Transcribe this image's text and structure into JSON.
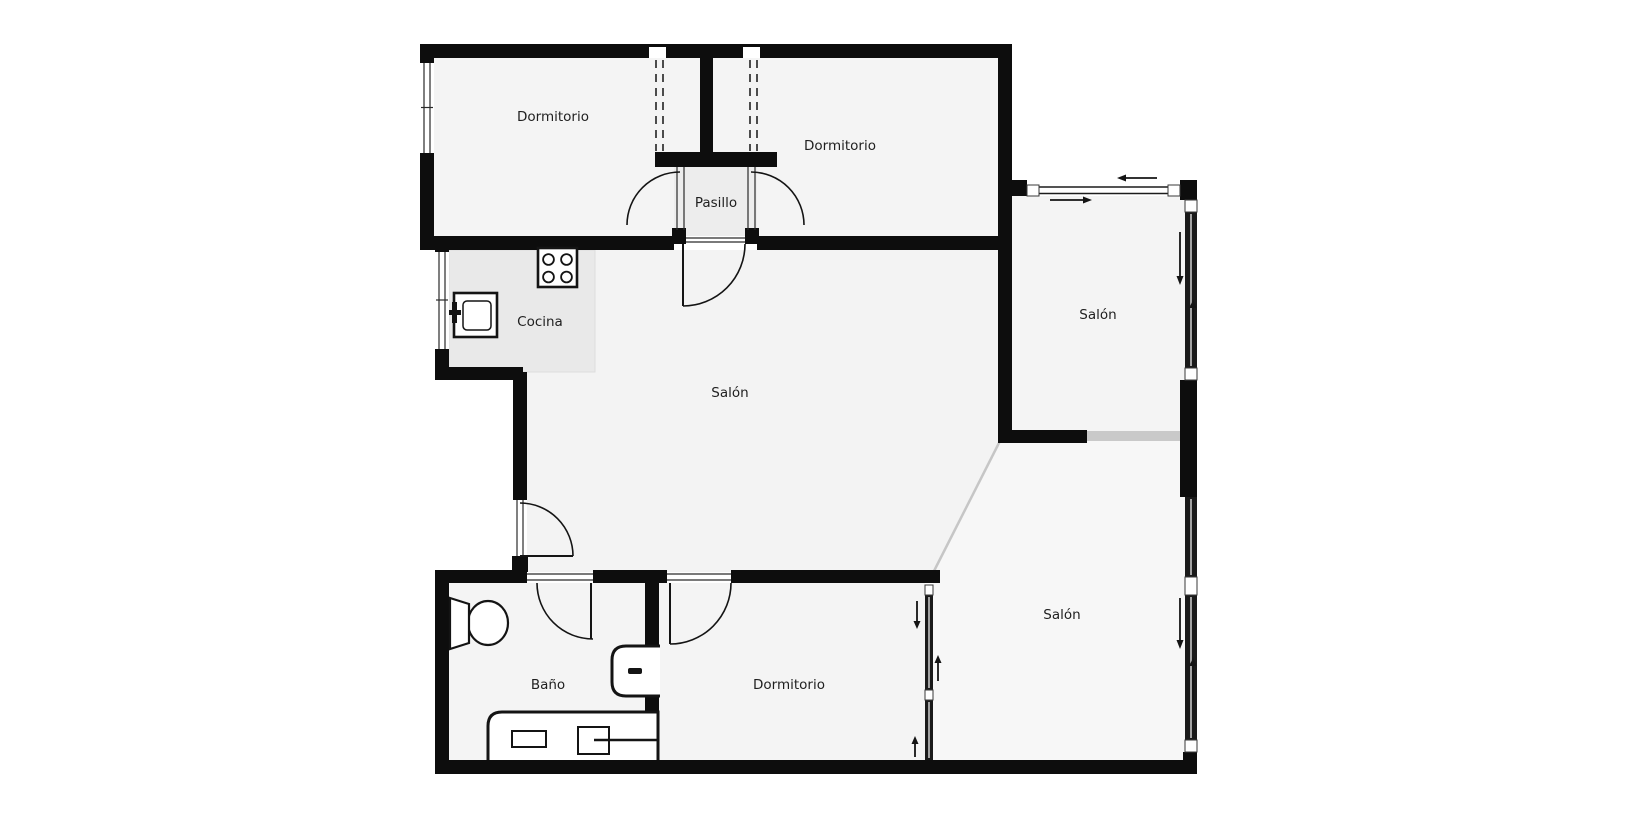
{
  "title": "Apartment floor plan",
  "colors": {
    "background": "#ffffff",
    "wall": "#0d0d0d",
    "glass_wall": "#1a1a1a",
    "room_fill": "#f4f4f4",
    "hall_fill": "#ededed",
    "kitchen_fill": "#e9e9e9",
    "salon_fill": "#f3f3f3",
    "salon_br_fill": "#f7f7f7",
    "glass_divider": "#c9c9c9",
    "label_color": "#1f1f1f"
  },
  "rooms": [
    {
      "id": "dormitorio-top-left",
      "label": "Dormitorio"
    },
    {
      "id": "dormitorio-top-right",
      "label": "Dormitorio"
    },
    {
      "id": "pasillo",
      "label": "Pasillo"
    },
    {
      "id": "cocina",
      "label": "Cocina"
    },
    {
      "id": "salon-central",
      "label": "Salón"
    },
    {
      "id": "salon-top-right",
      "label": "Salón"
    },
    {
      "id": "salon-bottom-right",
      "label": "Salón"
    },
    {
      "id": "bano",
      "label": "Baño"
    },
    {
      "id": "dormitorio-bottom",
      "label": "Dormitorio"
    }
  ],
  "fixtures": [
    {
      "id": "stove",
      "room": "cocina"
    },
    {
      "id": "kitchen-sink",
      "room": "cocina"
    },
    {
      "id": "toilet",
      "room": "bano"
    },
    {
      "id": "washbasin",
      "room": "bano"
    },
    {
      "id": "bathtub",
      "room": "bano"
    }
  ],
  "openings": {
    "hinged_doors": 6,
    "sliding_glass_walls": [
      "salon-top-right-north",
      "salon-top-right-east",
      "salon-bottom-right-east",
      "dormitorio-bottom-partition"
    ],
    "windows": [
      "dormitorio-top-left-west",
      "cocina-west"
    ],
    "dashed_wardrobes": [
      "dormitorio-top-left",
      "dormitorio-top-right"
    ]
  },
  "arrows": [
    {
      "id": "slide-top-right-arrow",
      "direction": "right"
    },
    {
      "id": "slide-top-left-arrow",
      "direction": "left"
    },
    {
      "id": "salon-tr-east-down-arrow",
      "direction": "down"
    },
    {
      "id": "salon-tr-east-up-arrow",
      "direction": "up"
    },
    {
      "id": "salon-br-east-down-arrow",
      "direction": "down"
    },
    {
      "id": "salon-br-east-up-arrow",
      "direction": "up"
    },
    {
      "id": "partition-down-arrow",
      "direction": "down"
    },
    {
      "id": "partition-up-arrow",
      "direction": "up"
    },
    {
      "id": "partition-lower-up-arrow",
      "direction": "up"
    }
  ]
}
